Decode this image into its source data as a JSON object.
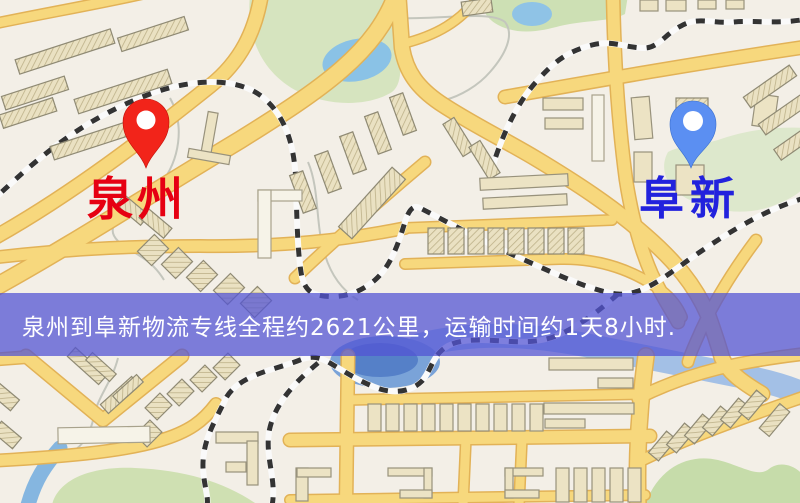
{
  "map": {
    "origin": {
      "name": "泉州",
      "pin_color": "#f2241a",
      "label_color": "#e60012"
    },
    "destination": {
      "name": "阜新",
      "pin_color": "#5b8ff2",
      "label_color": "#2222dd"
    },
    "banner": {
      "text": "泉州到阜新物流专线全程约2621公里，运输时间约1天8小时.",
      "background": "#5254d4",
      "text_color": "#ffffff"
    }
  }
}
